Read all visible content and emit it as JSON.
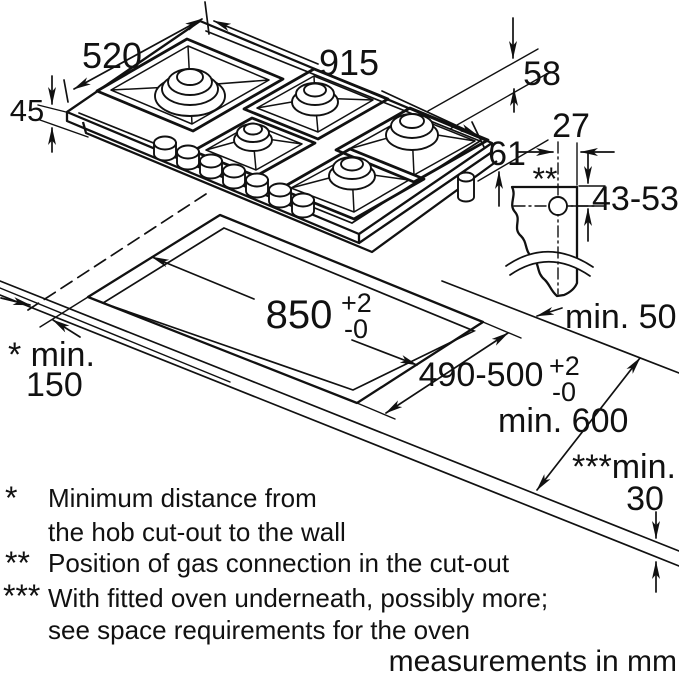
{
  "title": "gas hob installation diagram",
  "colors": {
    "ink": "#111111",
    "background": "#ffffff",
    "burner_cap": "#d8d8d8",
    "burner_cap_top": "#c9c9c9"
  },
  "dimensions": {
    "hob_width": "915",
    "hob_depth": "520",
    "install_depth": "45",
    "height_grate": "58",
    "height_total": "61",
    "gas_offset": "27",
    "gas_marker": "**",
    "gas_height_range": "43-53",
    "cutout_width": "850",
    "cutout_width_tol_plus": "+2",
    "cutout_width_tol_minus": "-0",
    "cutout_depth": "490-500",
    "cutout_depth_tol_plus": "+2",
    "cutout_depth_tol_minus": "-0",
    "min_rear_clearance": "min. 50",
    "min_wall_prefix": "* min.",
    "min_wall_value": "150",
    "min_worktop_depth": "min. 600",
    "min_oven_prefix": "***min.",
    "min_oven_value": "30"
  },
  "footnotes": {
    "star1_marker": "*",
    "star1_line1": "Minimum distance from",
    "star1_line2": "the hob cut-out to the wall",
    "star2_marker": "**",
    "star2_line1": "Position of gas connection in the cut-out",
    "star3_marker": "***",
    "star3_line1": "With fitted oven underneath, possibly more;",
    "star3_line2": "see space requirements for the oven"
  },
  "caption": "measurements in mm"
}
